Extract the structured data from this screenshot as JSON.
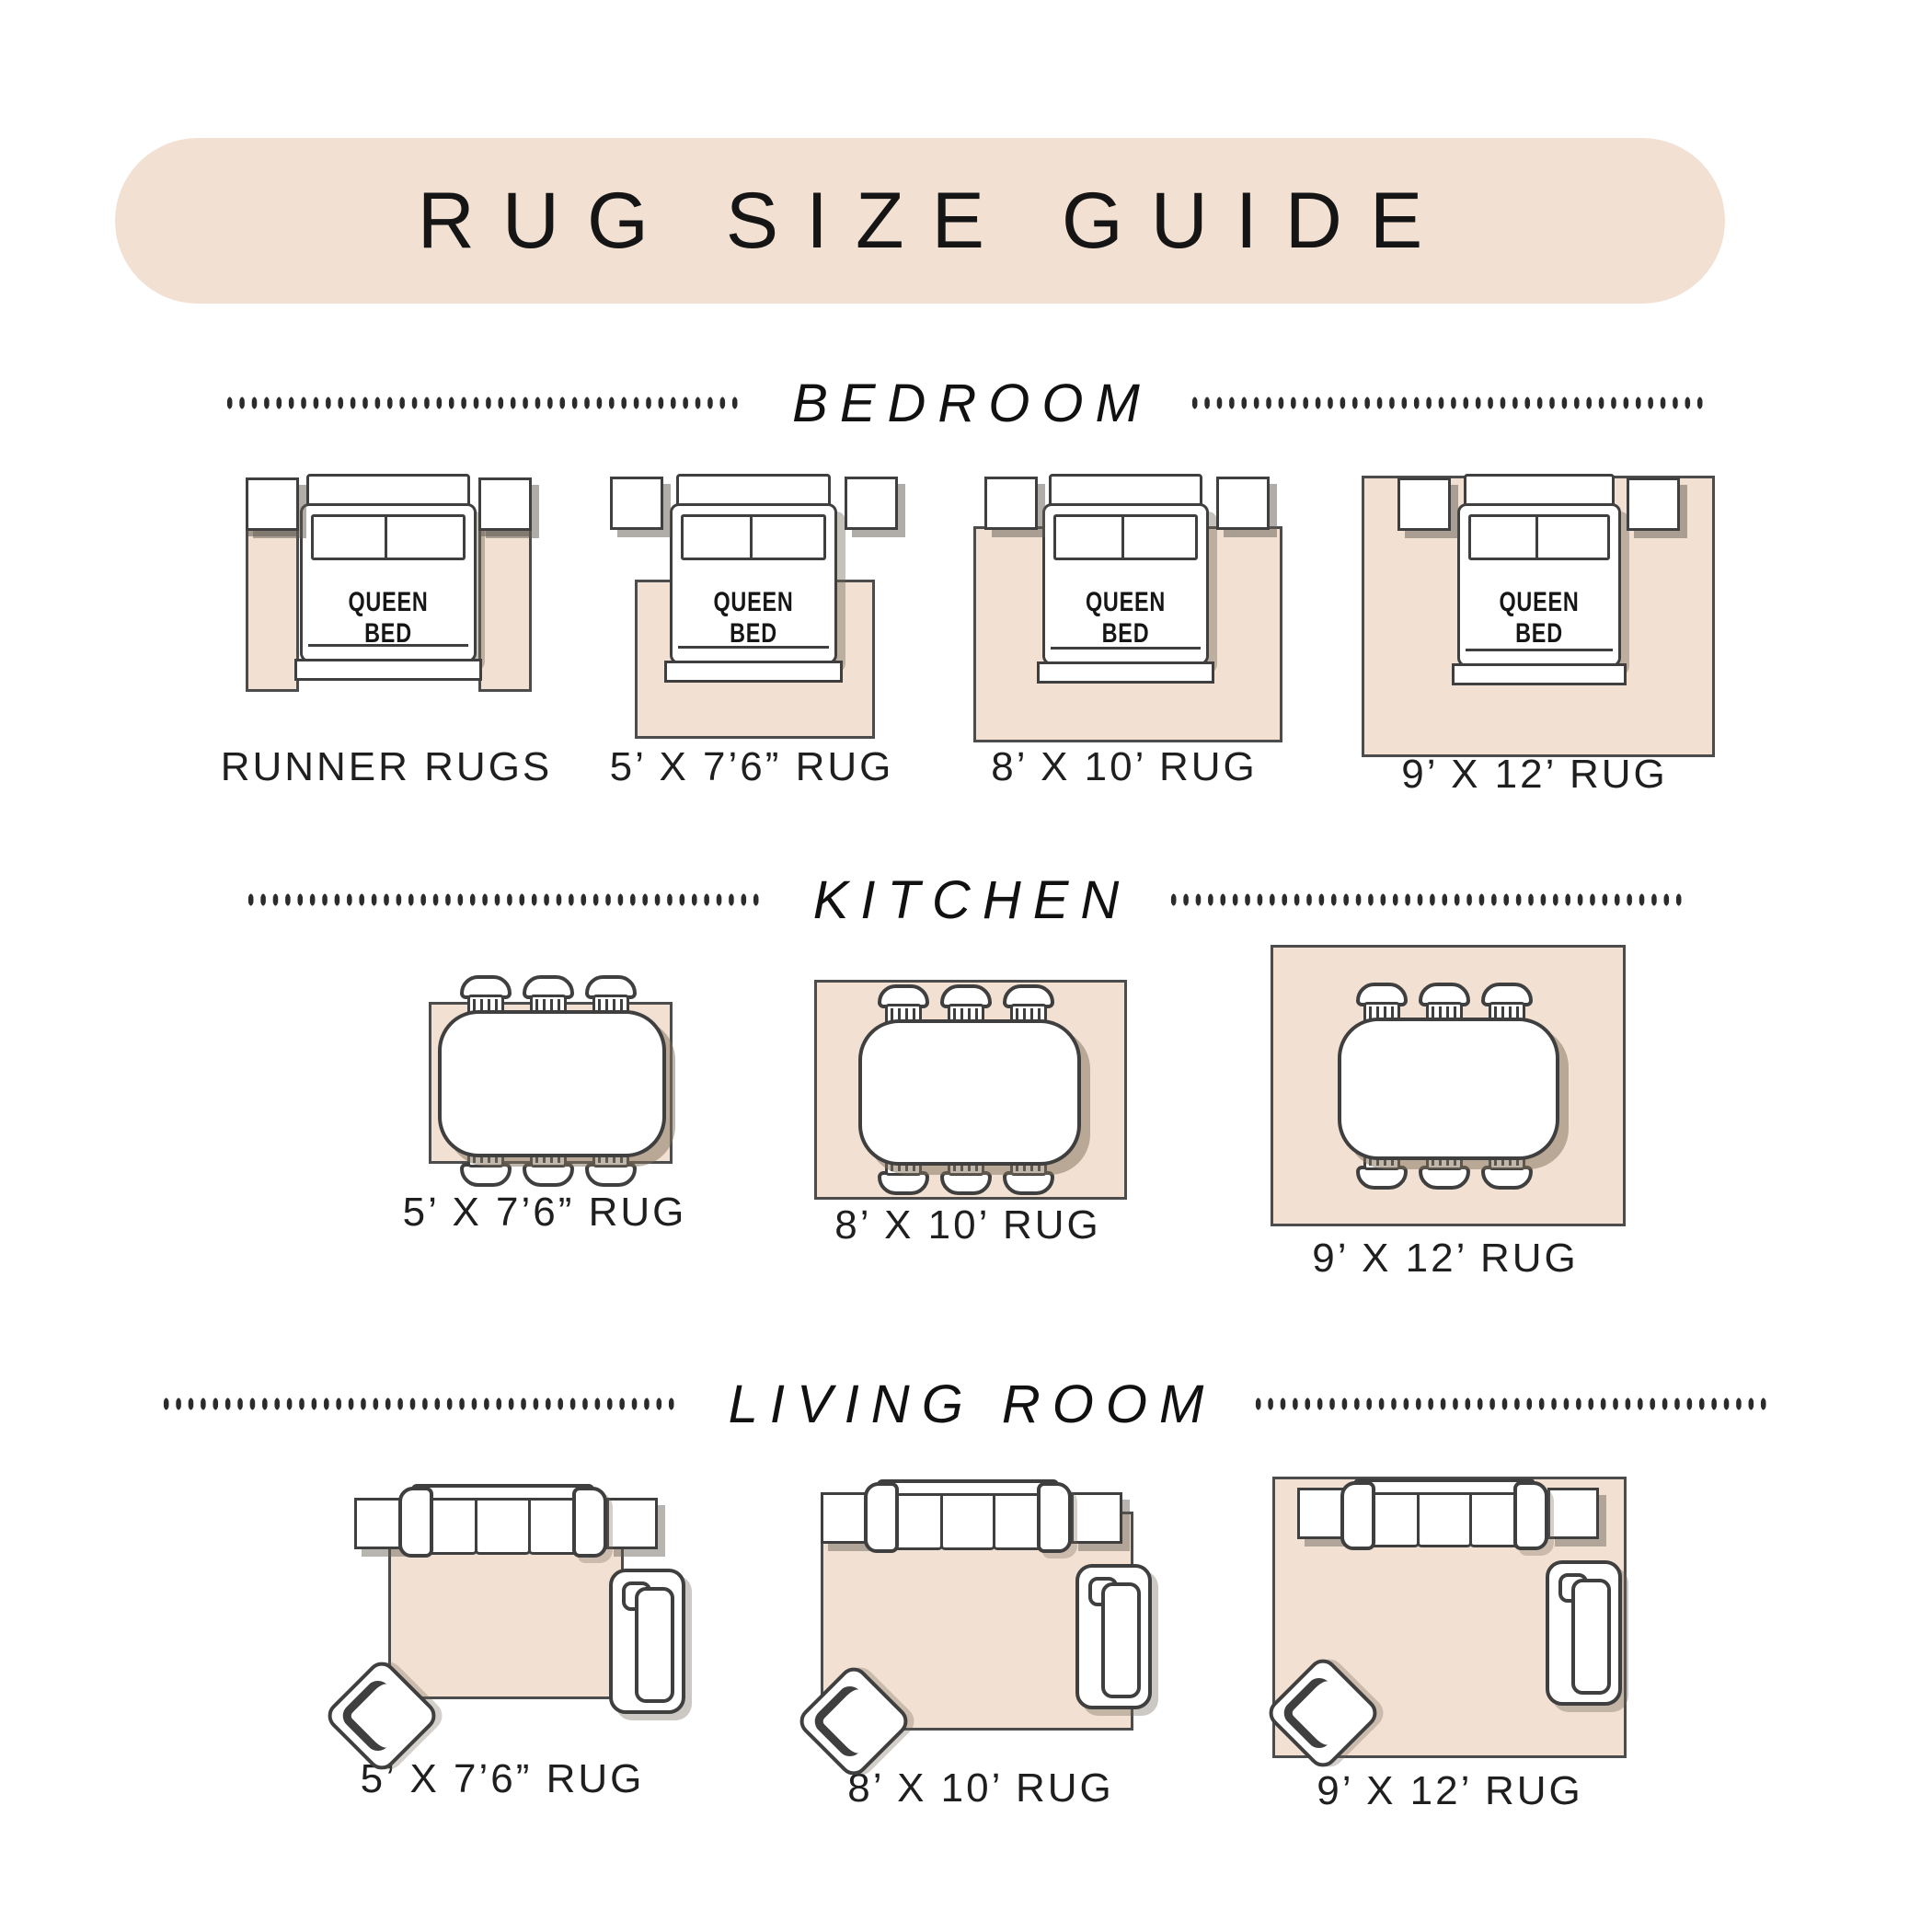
{
  "header": {
    "title": "RUG SIZE GUIDE"
  },
  "bed_label": "QUEEN BED",
  "colors": {
    "accent_beige": "#f2e1d2",
    "outline": "#3f3f3f",
    "text": "#1c1c1c"
  },
  "sections": [
    {
      "title": "BEDROOM",
      "figures": [
        {
          "label": "RUNNER RUGS"
        },
        {
          "label": "5’ X 7’6” RUG"
        },
        {
          "label": "8’ X 10’ RUG"
        },
        {
          "label": "9’ X 12’ RUG"
        }
      ]
    },
    {
      "title": "KITCHEN",
      "figures": [
        {
          "label": "5’ X 7’6” RUG"
        },
        {
          "label": "8’ X 10’ RUG"
        },
        {
          "label": "9’ X 12’ RUG"
        }
      ]
    },
    {
      "title": "LIVING ROOM",
      "figures": [
        {
          "label": "5’ X 7’6” RUG"
        },
        {
          "label": "8’ X 10’ RUG"
        },
        {
          "label": "9’ X 12’ RUG"
        }
      ]
    }
  ]
}
